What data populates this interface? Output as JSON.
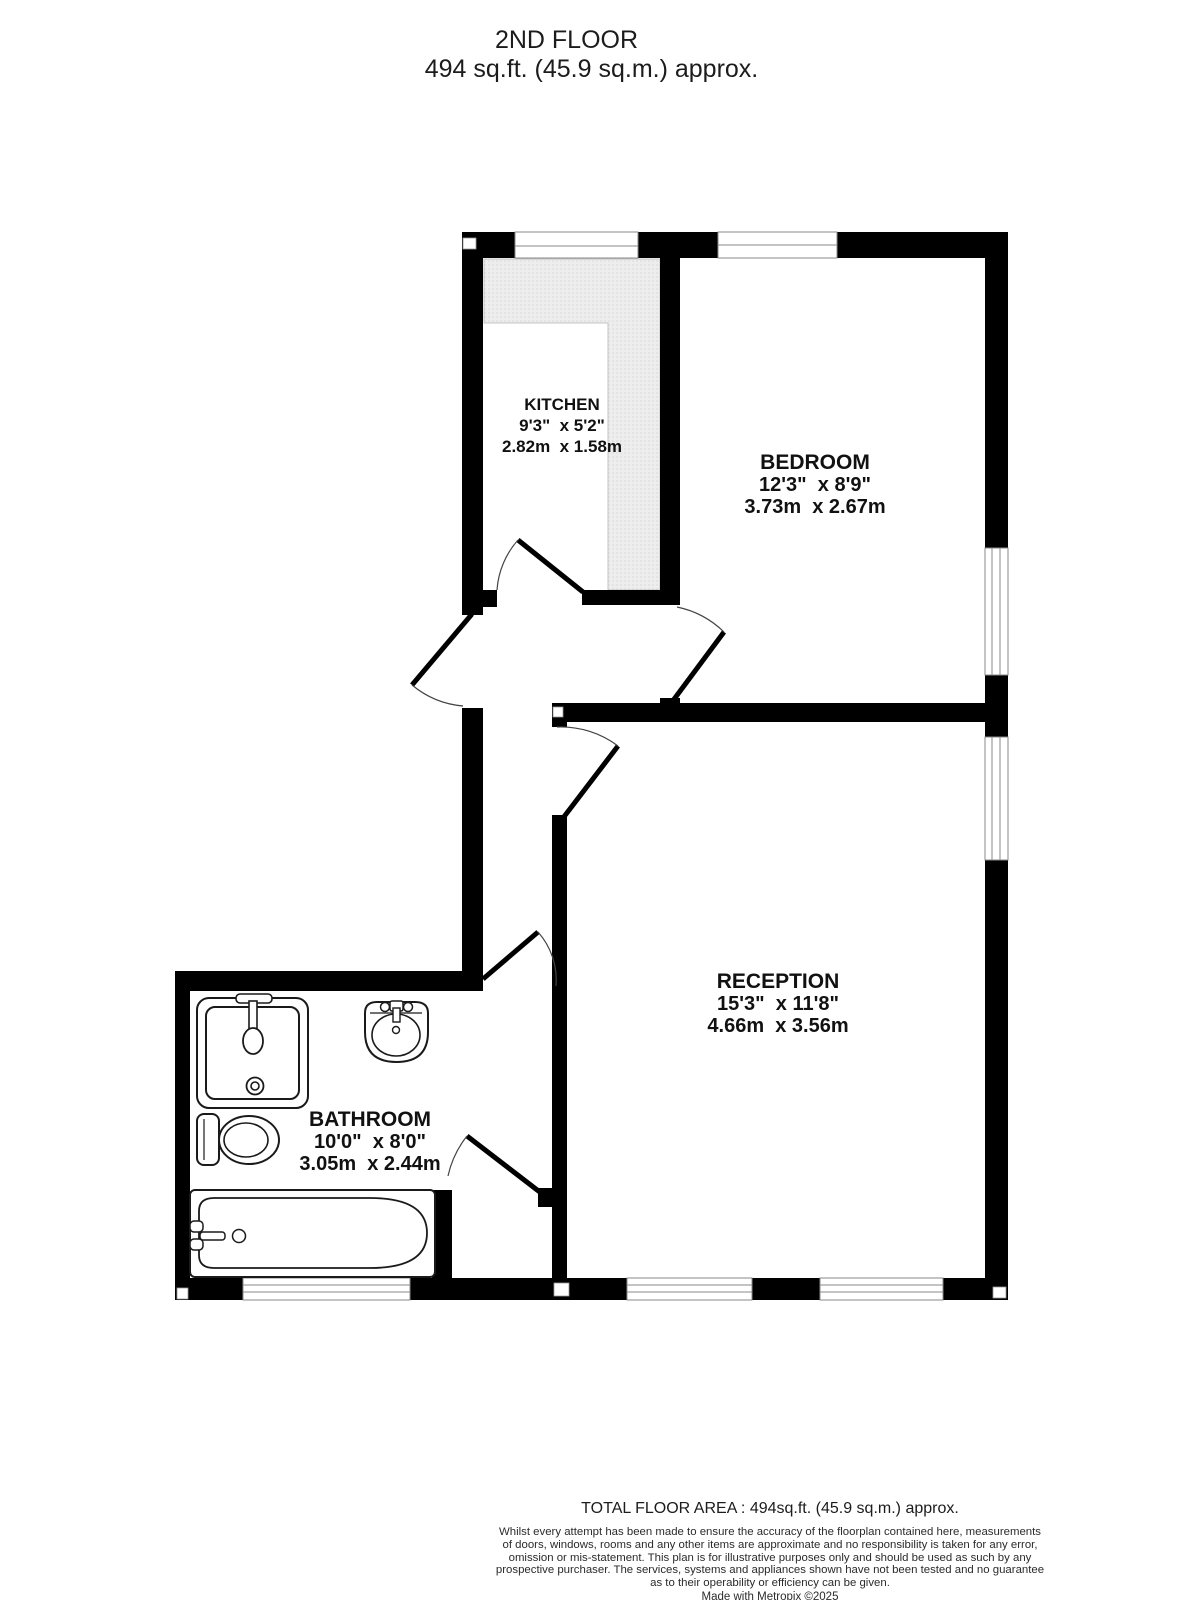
{
  "title": {
    "line1": "2ND FLOOR",
    "line2": "494 sq.ft. (45.9 sq.m.) approx."
  },
  "rooms": {
    "kitchen": {
      "name": "KITCHEN",
      "imperial": "9'3\"  x 5'2\"",
      "metric": "2.82m  x 1.58m"
    },
    "bedroom": {
      "name": "BEDROOM",
      "imperial": "12'3\"  x 8'9\"",
      "metric": "3.73m  x 2.67m"
    },
    "reception": {
      "name": "RECEPTION",
      "imperial": "15'3\"  x 11'8\"",
      "metric": "4.66m  x 3.56m"
    },
    "bathroom": {
      "name": "BATHROOM",
      "imperial": "10'0\"  x 8'0\"",
      "metric": "3.05m  x 2.44m"
    }
  },
  "footer": {
    "total": "TOTAL FLOOR AREA : 494sq.ft. (45.9 sq.m.) approx.",
    "disclaimer": [
      "Whilst every attempt has been made to ensure the accuracy of the floorplan contained here, measurements",
      "of doors, windows, rooms and any other items are approximate and no responsibility is taken for any error,",
      "omission or mis-statement. This plan is for illustrative purposes only and should be used as such by any",
      "prospective purchaser. The services, systems and appliances shown have not been tested and no guarantee",
      "as to their operability or efficiency can be given."
    ],
    "credit": "Made with Metropix ©2025"
  },
  "colors": {
    "wall": "#000000",
    "floor": "#ffffff",
    "counter_fill": "#ededed",
    "counter_dot": "#d8d8d8",
    "window_line": "#8a8a8a",
    "door_arc": "#444444",
    "text": "#111111"
  }
}
